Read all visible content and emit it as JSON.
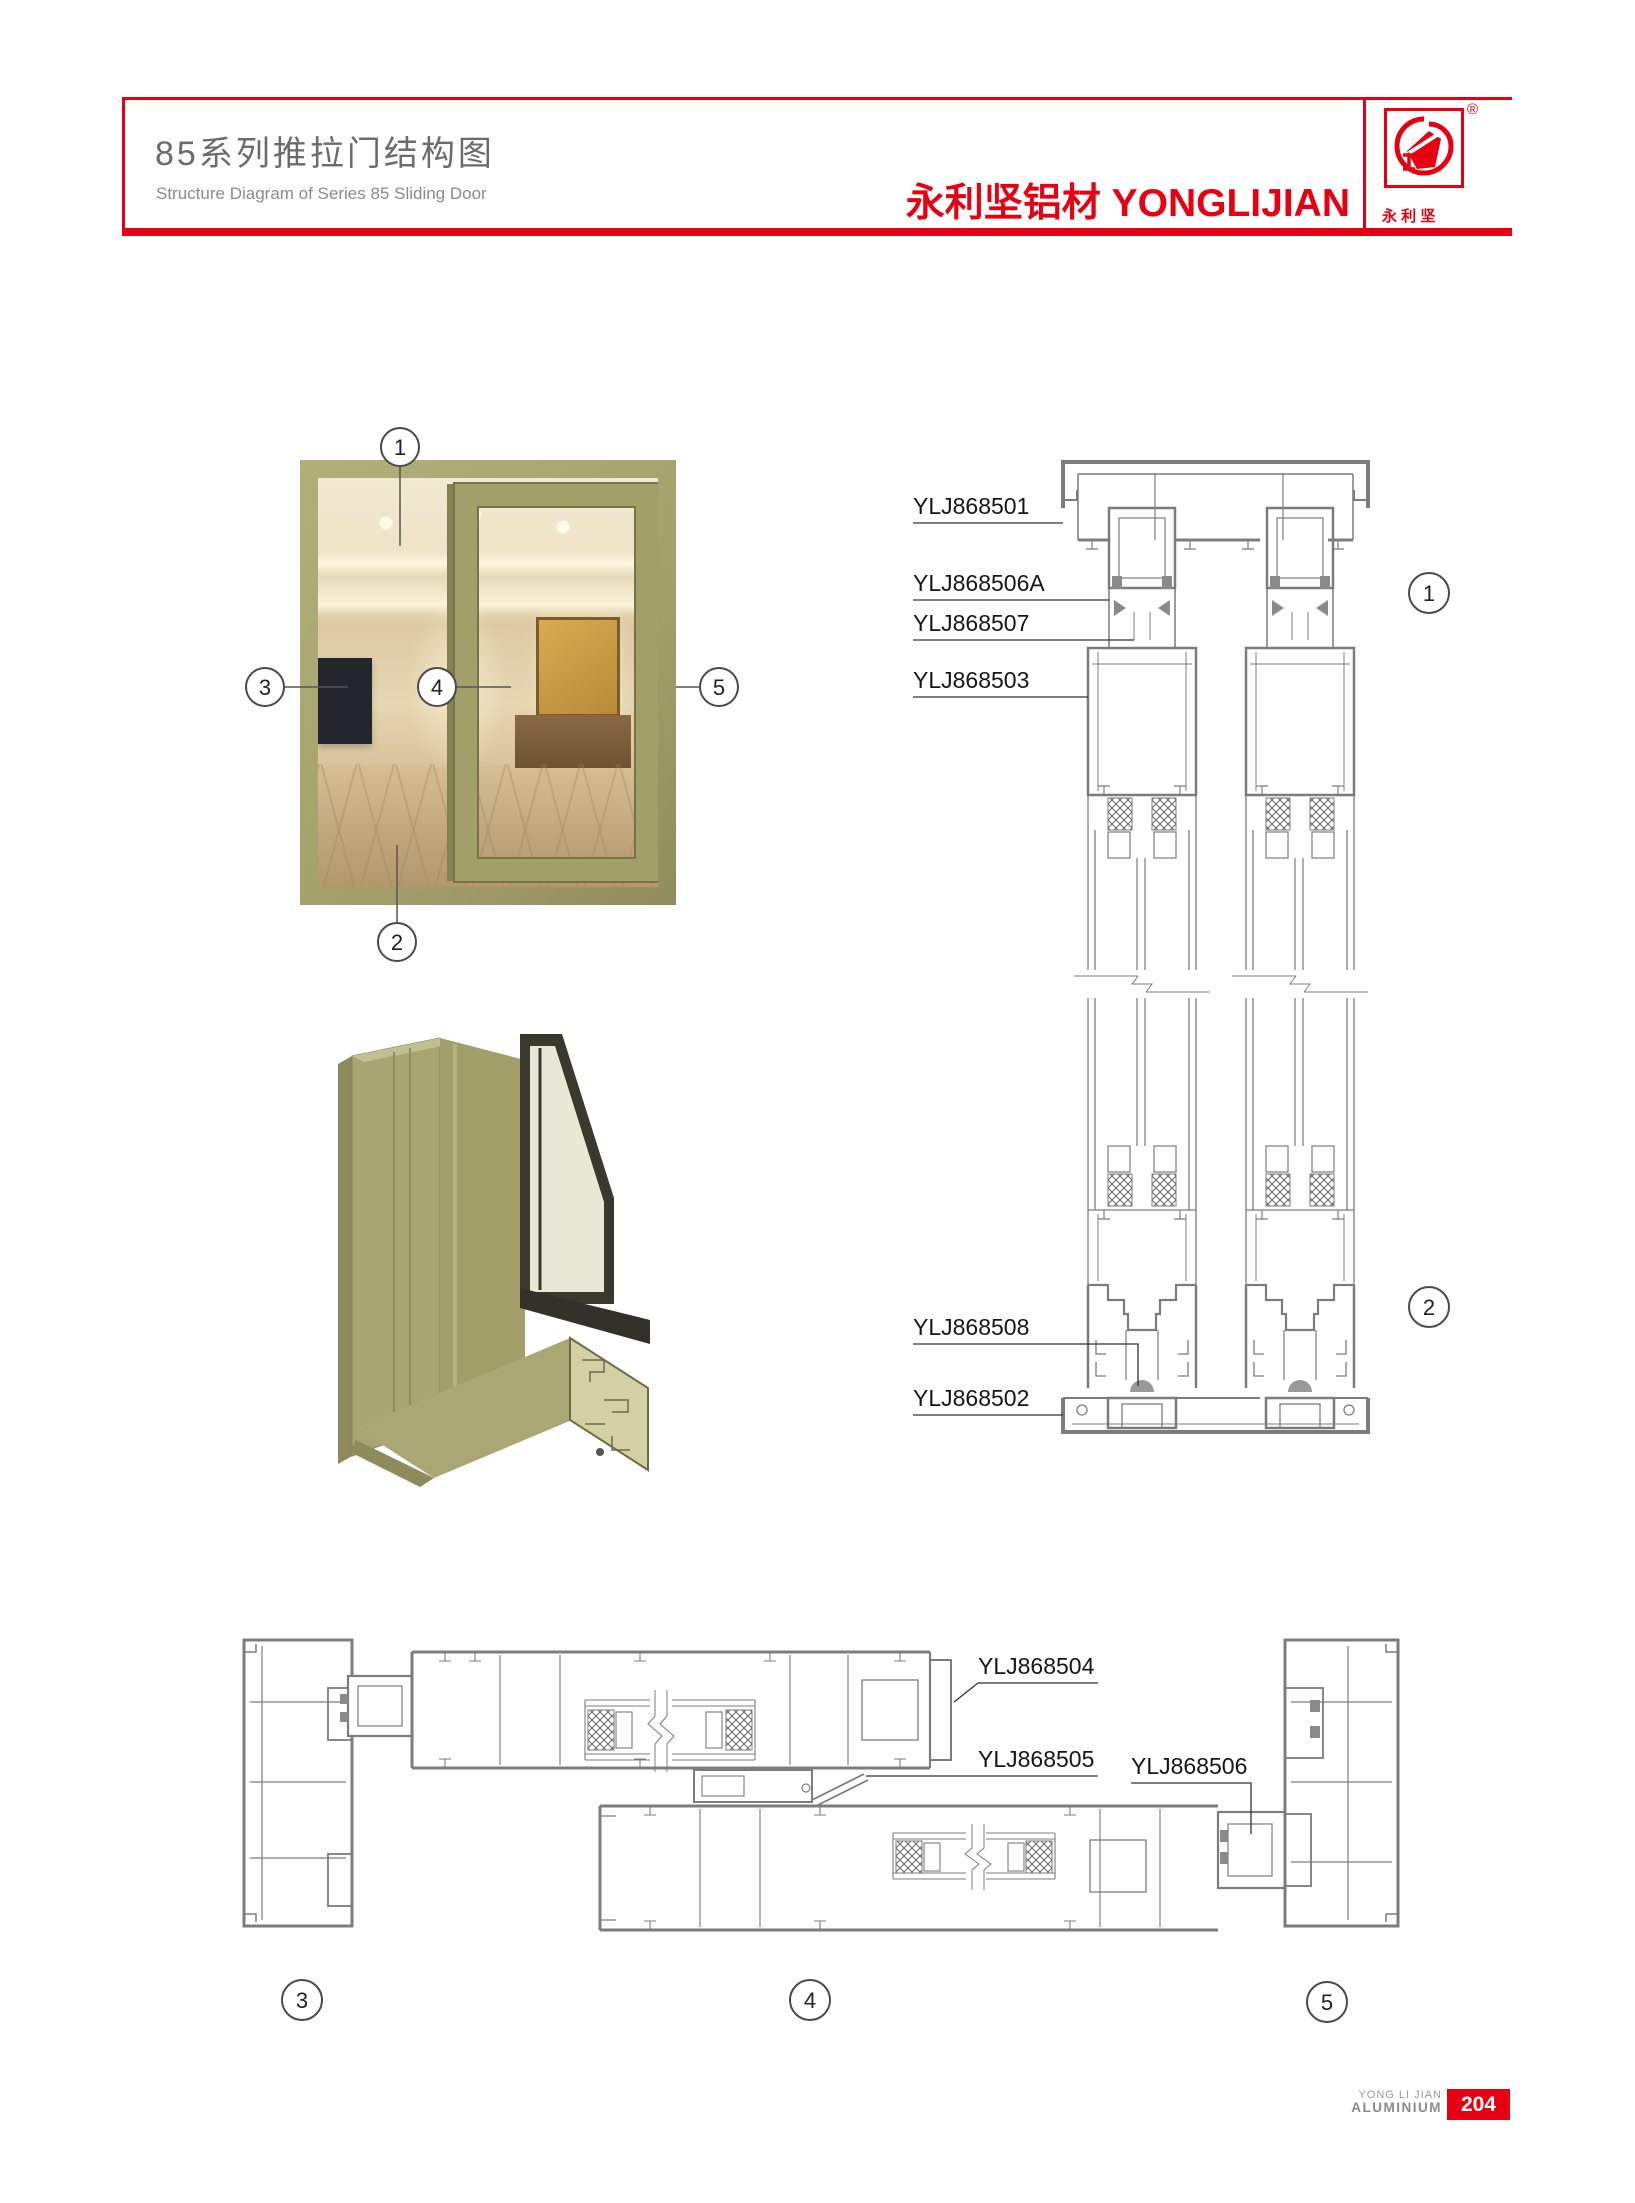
{
  "page": {
    "accent_red": "#e60012",
    "olive": "#a8a572",
    "line_gray": "#7c7c7c"
  },
  "header": {
    "title_cn": "85系列推拉门结构图",
    "title_en": "Structure Diagram of Series 85 Sliding Door",
    "brand": "永利坚铝材 YONGLIJIAN",
    "registered_mark": "®",
    "logo_chars": "永 利 坚"
  },
  "diagram": {
    "part_labels": {
      "p501": "YLJ868501",
      "p506a": "YLJ868506A",
      "p507": "YLJ868507",
      "p503": "YLJ868503",
      "p508": "YLJ868508",
      "p502": "YLJ868502",
      "p504": "YLJ868504",
      "p505": "YLJ868505",
      "p506": "YLJ868506"
    },
    "callouts": {
      "c1": "1",
      "c2": "2",
      "c3": "3",
      "c4": "4",
      "c5": "5"
    }
  },
  "footer": {
    "brand_line1": "YONG LI JIAN",
    "brand_line2": "ALUMINIUM",
    "page_number": "204"
  }
}
